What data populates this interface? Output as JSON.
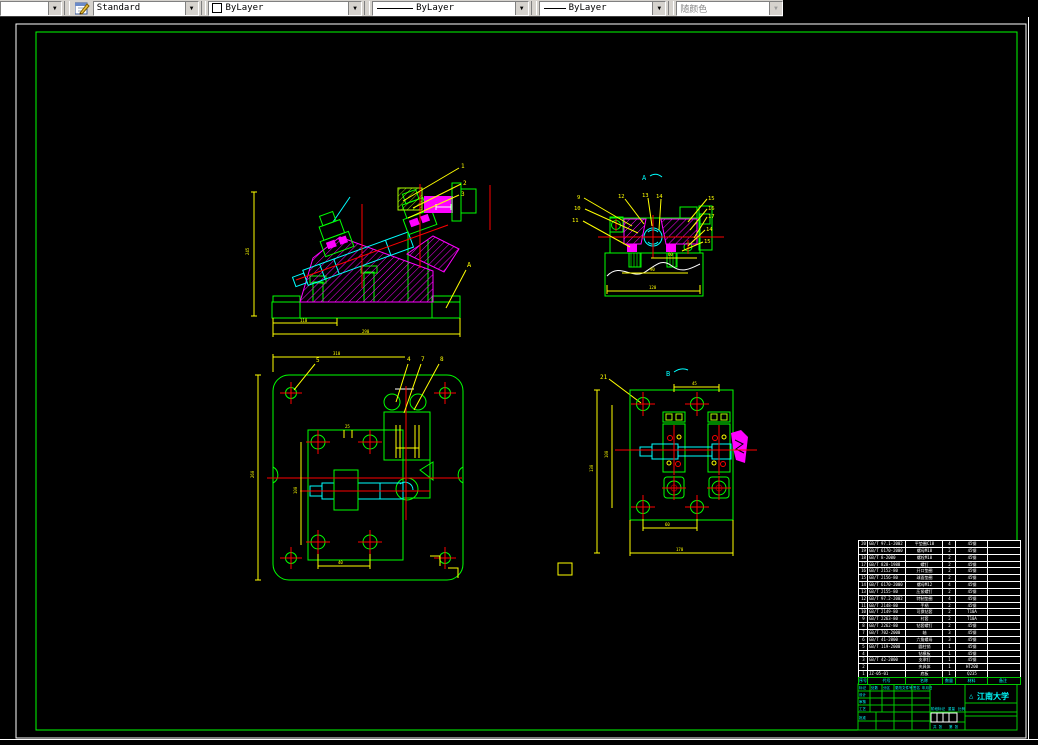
{
  "toolbar": {
    "style_combo": {
      "value": "Standard"
    },
    "color_combo": {
      "value": "ByLayer"
    },
    "linetype_combo": {
      "value": "ByLayer"
    },
    "lineweight_combo": {
      "value": "ByLayer"
    },
    "plotstyle_combo": {
      "value": "随颜色",
      "disabled": true
    }
  },
  "colors": {
    "toolbar_bg": "#d6d3ce",
    "paper_edge": "#ffffff",
    "frame_green": "#00ff00",
    "entity_green": "#00ff00",
    "entity_magenta": "#ff00ff",
    "entity_cyan": "#00ffff",
    "dim_yellow": "#ffff00",
    "centerline_red": "#ff0000"
  },
  "views": {
    "front": {
      "leaders": [
        "1",
        "2",
        "3"
      ],
      "section_arrow": "A",
      "dims": {
        "left": "245",
        "bottom1": "110",
        "bottom2": "290"
      }
    },
    "section_a": {
      "mark": "A",
      "leaders_left": [
        "9",
        "10",
        "11"
      ],
      "leaders_top": [
        "12",
        "13",
        "14"
      ],
      "leaders_right": [
        "15",
        "16",
        "17",
        "14",
        "15"
      ],
      "dims": {
        "d1": "60",
        "d2": "90",
        "d3": "120"
      }
    },
    "plan": {
      "leaders": [
        "5",
        "4",
        "7",
        "8"
      ],
      "dims": {
        "top": "310",
        "left": "260",
        "inner": "100",
        "bottom": "40",
        "small": "25"
      }
    },
    "view_b": {
      "mark": "B",
      "leaders": [
        "21"
      ],
      "dims": {
        "top": "45",
        "left1": "130",
        "left2": "100",
        "bottom1": "60",
        "bottom2": "170"
      }
    }
  },
  "parts_list": {
    "columns": [
      "序号",
      "代号",
      "名称",
      "数量",
      "材料",
      "备注"
    ],
    "rows": [
      [
        "20",
        "GB/T 97.1-2002",
        "平垫圈C10",
        "4",
        "45钢",
        ""
      ],
      [
        "19",
        "GB/T 6170-2000",
        "螺母M10",
        "2",
        "45钢",
        ""
      ],
      [
        "18",
        "GB/T 8-2000",
        "螺栓M10",
        "2",
        "45钢",
        ""
      ],
      [
        "17",
        "GB/T 828-1988",
        "螺钉",
        "2",
        "45钢",
        ""
      ],
      [
        "16",
        "GB/T 2152-80",
        "开口垫圈",
        "2",
        "45钢",
        ""
      ],
      [
        "15",
        "GB/T 2156-80",
        "球面垫圈",
        "2",
        "45钢",
        ""
      ],
      [
        "14",
        "GB/T 6170-2000",
        "螺母M12",
        "4",
        "45钢",
        ""
      ],
      [
        "13",
        "GB/T 2155-80",
        "压紧螺钉",
        "2",
        "45钢",
        ""
      ],
      [
        "12",
        "GB/T 97.2-2002",
        "特制垫圈",
        "4",
        "45钢",
        ""
      ],
      [
        "11",
        "GB/T 2148-80",
        "手柄",
        "2",
        "45钢",
        ""
      ],
      [
        "10",
        "GB/T 2149-80",
        "可换钻套",
        "2",
        "T10A",
        ""
      ],
      [
        "9",
        "GB/T 2263-80",
        "衬套",
        "2",
        "T10A",
        ""
      ],
      [
        "8",
        "GB/T 2262-80",
        "钻套螺钉",
        "2",
        "45钢",
        ""
      ],
      [
        "7",
        "GB/T 702-2000",
        "轴",
        "3",
        "45钢",
        ""
      ],
      [
        "6",
        "GB/T 41-2000",
        "六角螺母",
        "3",
        "45钢",
        ""
      ],
      [
        "5",
        "GB/T 119-2000",
        "圆柱销",
        "1",
        "45钢",
        ""
      ],
      [
        "4",
        "",
        "钻模板",
        "1",
        "45钢",
        ""
      ],
      [
        "3",
        "GB/T 42-2000",
        "支承钉",
        "1",
        "45钢",
        ""
      ],
      [
        "2",
        "",
        "夹具体",
        "1",
        "HT200",
        ""
      ],
      [
        "1",
        "JZ-05-01",
        "底板",
        "1",
        "Q235",
        ""
      ]
    ]
  },
  "title_block": {
    "logo": "△",
    "university": "江南大学",
    "rev_header": [
      "标记",
      "处数",
      "分区",
      "更改文件号",
      "签名",
      "年月日"
    ],
    "design": "设计",
    "check": "审核",
    "process": "工艺",
    "approve": "批准",
    "stage": "阶段标记",
    "weight": "重量",
    "scale": "比例",
    "sheet1": "共 张",
    "sheet2": "第 张"
  }
}
